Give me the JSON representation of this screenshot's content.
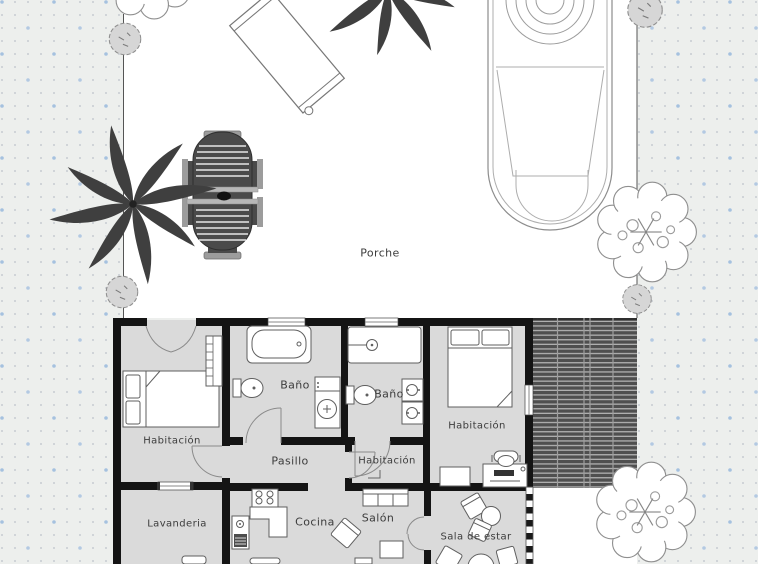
{
  "plan": {
    "labels": {
      "porch": "Porche",
      "bedroom_left": "Habitación",
      "bathroom_1": "Baño",
      "bathroom_2": "Baño",
      "bedroom_right": "Habitación",
      "hallway": "Pasillo",
      "bedroom_middle": "Habitación",
      "laundry": "Lavanderia",
      "kitchen": "Cocina",
      "living_room": "Salón",
      "sitting_room": "Sala de estar"
    },
    "colors": {
      "background": "#edefed",
      "dot_small": "#c6cbd1",
      "dot_accent": "#a5c1df",
      "yard_white": "#ffffff",
      "floor_gray": "#dadada",
      "wall_black": "#141414",
      "deck_dark": "#4f4f4f",
      "deck_light": "#b0b0b0",
      "label_text": "#3c3c3c"
    },
    "icons": [
      "palm-tree-icon",
      "deciduous-tree-icon",
      "bush-icon",
      "pool-icon",
      "sun-lounger-icon",
      "dining-set-icon",
      "bed-icon",
      "wardrobe-icon",
      "bathtub-icon",
      "toilet-icon",
      "washbasin-icon",
      "shower-icon",
      "double-sink-icon",
      "desk-icon",
      "office-chair-icon",
      "dresser-icon",
      "stove-icon",
      "kitchen-counter-icon",
      "laundry-sink-icon",
      "sofa-icon",
      "armchair-icon",
      "coffee-table-icon",
      "round-table-icon",
      "door-arc",
      "window",
      "sliding-glass-door"
    ]
  }
}
